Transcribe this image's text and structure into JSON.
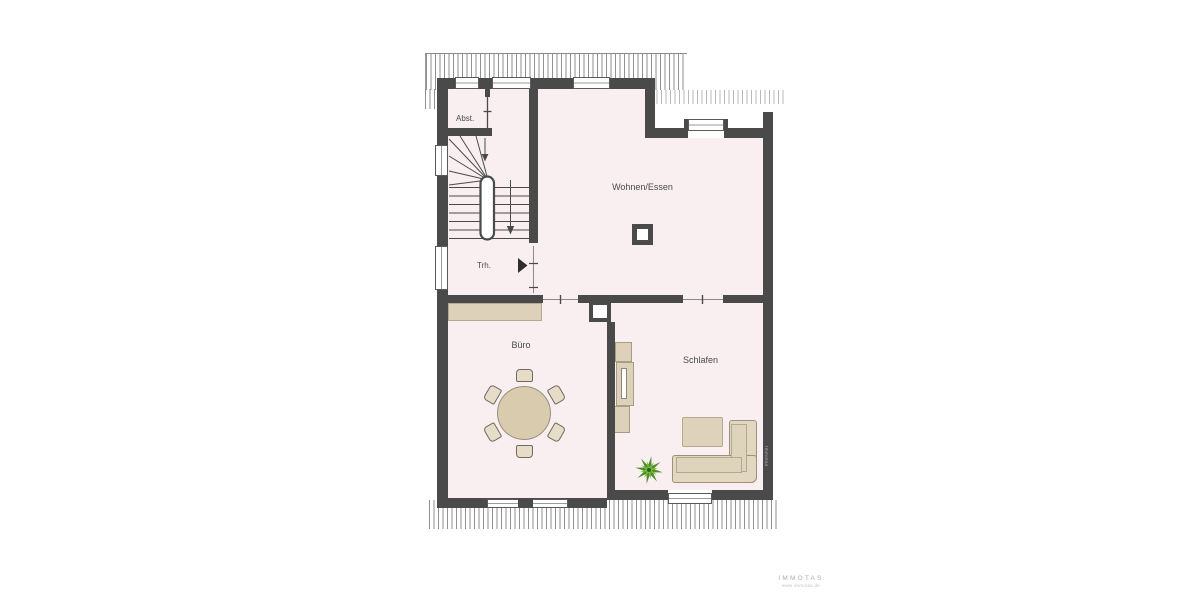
{
  "rooms": {
    "abst": {
      "label": "Abst."
    },
    "trh": {
      "label": "Trh."
    },
    "wohnen": {
      "label": "Wohnen/Essen"
    },
    "buero": {
      "label": "Büro"
    },
    "schlafen": {
      "label": "Schlafen"
    }
  },
  "watermark": {
    "brand": "IMMOTAS",
    "sub": "www.immotas.de",
    "side": "Immotas"
  },
  "colors": {
    "wall": "#4a4a4a",
    "room_fill": "#f9eff1",
    "furniture_tan": "#ddd2b9",
    "sofa_tan": "#e2d8c2",
    "plant_green": "#5d9a33",
    "hatch_gray": "#8f8f8f",
    "label_text": "#4a4a4a",
    "watermark_gray": "#b3b3b3"
  },
  "furniture": {
    "dining_table": {
      "room": "Büro",
      "chairs": 6
    },
    "sideboard": {
      "room": "Büro"
    },
    "wardrobe": {
      "room": "Schlafen"
    },
    "coffee_table": {
      "room": "Schlafen"
    },
    "corner_sofa": {
      "room": "Schlafen"
    },
    "plant": {
      "room": "Schlafen"
    },
    "chimney": {
      "room": "Wohnen/Essen"
    },
    "shaft": {
      "room": "Büro"
    }
  }
}
